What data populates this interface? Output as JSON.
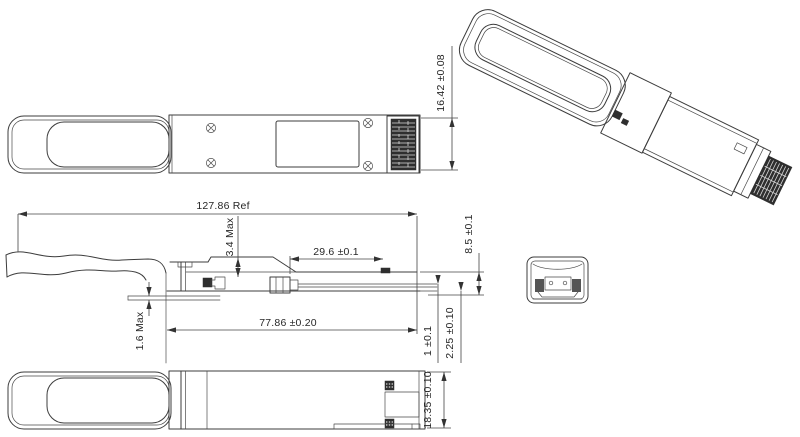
{
  "drawing": {
    "type": "mechanical-drawing",
    "subject": "QSFP optical transceiver module outline",
    "colors": {
      "background": "#ffffff",
      "line": "#3c3c3c",
      "text": "#262626",
      "connector_fill": "#2e2e2e"
    }
  },
  "dims": {
    "top_height": "16.42 ±0.08",
    "overall_length": "127.86 Ref",
    "latch_height": "3.4 Max",
    "tail_length": "29.6 ±0.1",
    "body_length": "77.86 ±0.20",
    "tab_thickness": "1.6 Max",
    "rear_height": "8.5 ±0.1",
    "paddle_thickness": "1 ±0.1",
    "paddle_offset": "2.25 ±0.10",
    "body_width": "18.35 ±0.10"
  }
}
